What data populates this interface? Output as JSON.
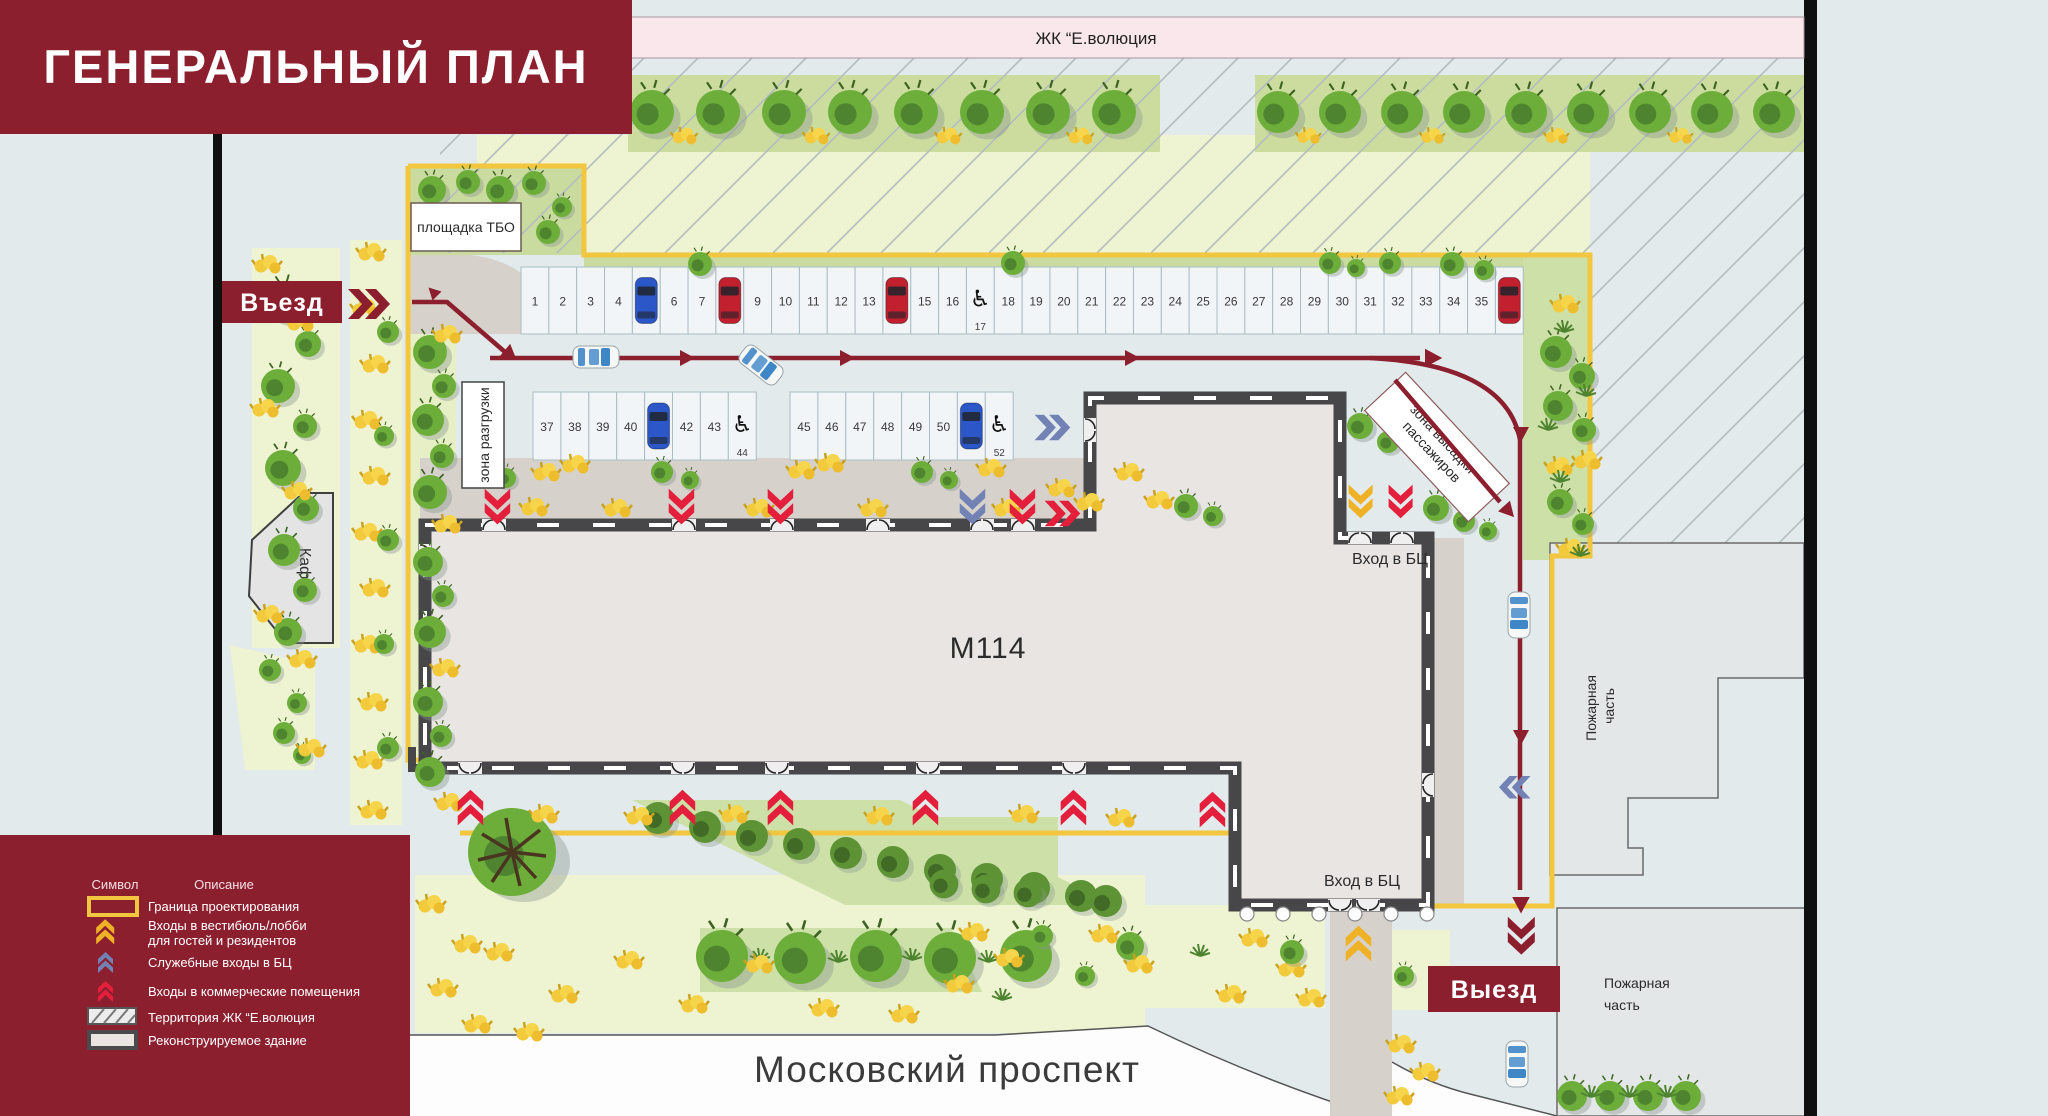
{
  "title": "ГЕНЕРАЛЬНЫЙ ПЛАН",
  "top_strip": {
    "label": "ЖК “Е.волюция"
  },
  "map": {
    "entry_label": "Въезд",
    "exit_label": "Выезд",
    "tbo_label": "площадка ТБО",
    "unloading_label": "зона разгрузки",
    "dropoff_line1": "зона высадки",
    "dropoff_line2": "пассажиров",
    "building_label": "М114",
    "bc_entrance_north_label": "Вход в БЦ",
    "bc_entrance_south_label": "Вход в БЦ",
    "cafe_label": "Кафе",
    "fire_station_right_line1": "Пожарная",
    "fire_station_right_line2": "часть",
    "fire_station_bottom_line1": "Пожарная",
    "fire_station_bottom_line2": "часть",
    "avenue_label": "Московский проспект"
  },
  "parking": {
    "row1": [
      {
        "n": "1"
      },
      {
        "n": "2"
      },
      {
        "n": "3"
      },
      {
        "n": "4"
      },
      {
        "car": "blue"
      },
      {
        "n": "6"
      },
      {
        "n": "7"
      },
      {
        "car": "red"
      },
      {
        "n": "9"
      },
      {
        "n": "10"
      },
      {
        "n": "11"
      },
      {
        "n": "12"
      },
      {
        "n": "13"
      },
      {
        "car": "red"
      },
      {
        "n": "15"
      },
      {
        "n": "16"
      },
      {
        "disabled": true,
        "n": "17"
      },
      {
        "n": "18"
      },
      {
        "n": "19"
      },
      {
        "n": "20"
      },
      {
        "n": "21"
      },
      {
        "n": "22"
      },
      {
        "n": "23"
      },
      {
        "n": "24"
      },
      {
        "n": "25"
      },
      {
        "n": "26"
      },
      {
        "n": "27"
      },
      {
        "n": "28"
      },
      {
        "n": "29"
      },
      {
        "n": "30"
      },
      {
        "n": "31"
      },
      {
        "n": "32"
      },
      {
        "n": "33"
      },
      {
        "n": "34"
      },
      {
        "n": "35"
      },
      {
        "car": "red"
      }
    ],
    "row2_group1": [
      {
        "n": "37"
      },
      {
        "n": "38"
      },
      {
        "n": "39"
      },
      {
        "n": "40"
      },
      {
        "car": "blue"
      },
      {
        "n": "42"
      },
      {
        "n": "43"
      },
      {
        "disabled": true,
        "n": "44"
      }
    ],
    "row2_group2": [
      {
        "n": "45"
      },
      {
        "n": "46"
      },
      {
        "n": "47"
      },
      {
        "n": "48"
      },
      {
        "n": "49"
      },
      {
        "n": "50"
      },
      {
        "car": "blue"
      },
      {
        "disabled": true,
        "n": "52"
      }
    ]
  },
  "legend": {
    "symbol_header": "Символ",
    "description_header": "Описание",
    "items": [
      {
        "swatch": "boundary",
        "label": "Граница проектирования"
      },
      {
        "swatch": "chevron-yellow",
        "label": "Входы в вестибюль/лобби",
        "label2": "для гостей и резидентов"
      },
      {
        "swatch": "chevron-blue",
        "label": "Служебные входы в БЦ"
      },
      {
        "swatch": "chevron-red",
        "label": "Входы в коммерческие помещения"
      },
      {
        "swatch": "hatch",
        "label": "Территория ЖК “Е.волюция"
      },
      {
        "swatch": "building",
        "label": "Реконструируемое здание"
      }
    ]
  },
  "colors": {
    "accent_dark_red": "#8c1f2e",
    "chevron_red": "#e31f3c",
    "chevron_yellow": "#efb227",
    "chevron_blue": "#7282b4",
    "boundary_yellow": "#f2c63e",
    "car_blue": "#2b57c8",
    "car_red": "#c3202f",
    "background": "#e2eaec",
    "pink_strip": "#f9e7ec",
    "pale_green": "#eef3d2",
    "band_green": "#cbdc9e"
  }
}
